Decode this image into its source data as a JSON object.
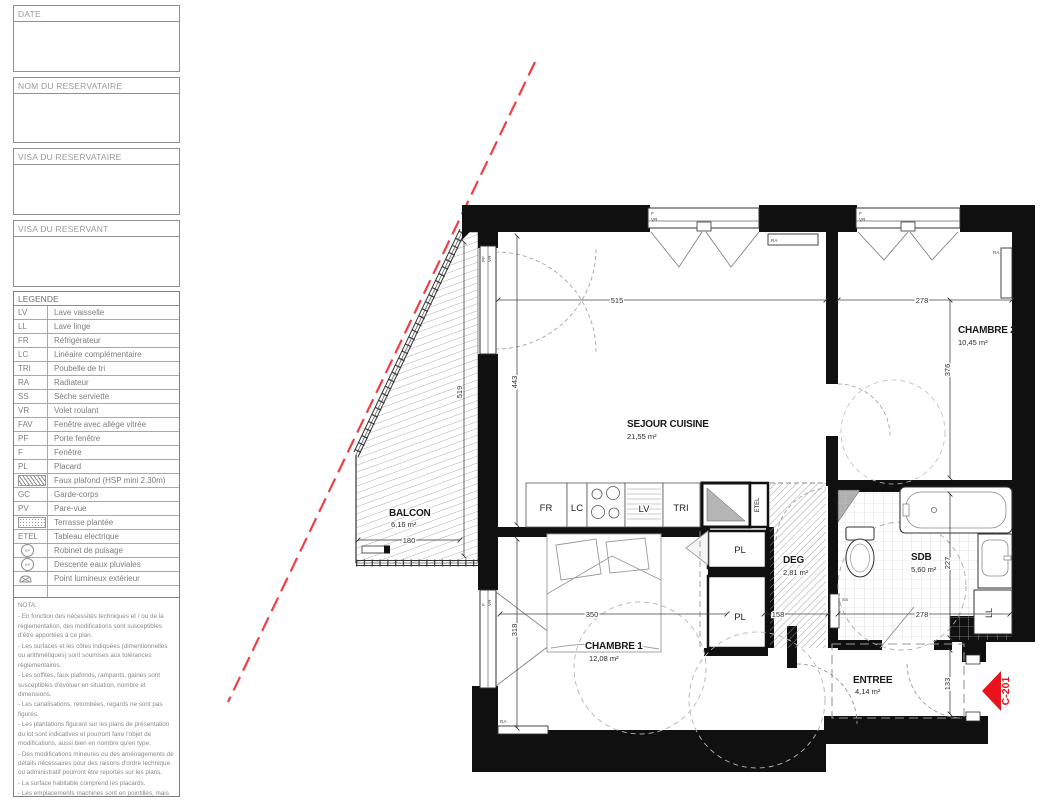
{
  "title_block": {
    "boxes": [
      {
        "label": "DATE"
      },
      {
        "label": "NOM DU RESERVATAIRE"
      },
      {
        "label": "VISA DU RESERVATAIRE"
      },
      {
        "label": "VISA DU RESERVANT"
      }
    ]
  },
  "legend": {
    "title": "LEGENDE",
    "items": [
      {
        "abbr": "LV",
        "label": "Lave vaisselle"
      },
      {
        "abbr": "LL",
        "label": "Lave linge"
      },
      {
        "abbr": "FR",
        "label": "Réfrigérateur"
      },
      {
        "abbr": "LC",
        "label": "Linéaire complémentaire"
      },
      {
        "abbr": "TRI",
        "label": "Poubelle de tri"
      },
      {
        "abbr": "RA",
        "label": "Radiateur"
      },
      {
        "abbr": "SS",
        "label": "Sèche serviette"
      },
      {
        "abbr": "VR",
        "label": "Volet roulant"
      },
      {
        "abbr": "FAV",
        "label": "Fenêtre avec allège vitrée"
      },
      {
        "abbr": "PF",
        "label": "Porte fenêtre"
      },
      {
        "abbr": "F",
        "label": "Fenêtre"
      },
      {
        "abbr": "PL",
        "label": "Placard"
      },
      {
        "abbr": "",
        "label": "Faux plafond (HSP mini 2.30m)",
        "icon": "hatch"
      },
      {
        "abbr": "GC",
        "label": "Garde-corps"
      },
      {
        "abbr": "PV",
        "label": "Pare-vue"
      },
      {
        "abbr": "",
        "label": "Terrasse plantée",
        "icon": "dots"
      },
      {
        "abbr": "ETEL",
        "label": "Tableau electrique"
      },
      {
        "abbr": "RP",
        "label": "Robinet de puisage",
        "icon": "rp"
      },
      {
        "abbr": "EP",
        "label": "Descente eaux pluviales",
        "icon": "ep"
      },
      {
        "abbr": "",
        "label": "Point lumineux extérieur",
        "icon": "lamp"
      }
    ]
  },
  "nota": {
    "title": "NOTA:",
    "lines": [
      "- En fonction des nécessités techniques et / ou de la réglementation, des modifications sont susceptibles d'être apportées à ce plan.",
      "- Les surfaces et les côtes indiquées (dimentionnelles ou arithmétiques) sont soumises aux tolérances réglementaires.",
      "- Les soffites, faux plafonds, rampants, gaines sont susceptibles d'évoluer en situation, nombre et dimensions.",
      "- Les canalisations, retombées, regards ne sont pas figurés.",
      "- Les plantations figurant sur les plans de présentation du lot sont indicatives et pourront faire l'objet de modifications, aussi bien en nombre qu'en type.",
      "- Des modifications mineures ou des aménagements de détails nécessaires pour des raisons d'ordre technique ou administratif pourront être reportés sur les plans.",
      "- La surface habitable comprend les placards.",
      "- Les emplacements machines sont en pointillés, mais les appareils ne sont pas fournis.",
      "- La literie indiquée dans la chambre est à titre indicatif de la norme handicapée. La literie est non fournie."
    ]
  },
  "plan": {
    "rooms": {
      "sejour": {
        "name": "SEJOUR CUISINE",
        "area": "21,55 m²"
      },
      "chambre2": {
        "name": "CHAMBRE 2",
        "area": "10,45 m²"
      },
      "chambre1": {
        "name": "CHAMBRE 1",
        "area": "12,08 m²"
      },
      "balcon": {
        "name": "BALCON",
        "area": "6,16 m²"
      },
      "deg": {
        "name": "DEG",
        "area": "2,81 m²"
      },
      "sdb": {
        "name": "SDB",
        "area": "5,60 m²"
      },
      "entree": {
        "name": "ENTREE",
        "area": "4,14 m²"
      }
    },
    "fixtures": {
      "fr": "FR",
      "lc": "LC",
      "lv": "LV",
      "tri": "TRI",
      "pl": "PL",
      "ll": "LL",
      "etel": "ETEL",
      "ss": "SS",
      "ra": "RA"
    },
    "windows": {
      "f": "F",
      "vr": "VR",
      "pf": "PF"
    },
    "dims": {
      "sejour_width": "515",
      "chambre2_width": "278",
      "sejour_height": "443",
      "balcon_height": "519",
      "chambre2_height": "376",
      "sdb_height": "227",
      "entree_height": "133",
      "chambre1_width": "350",
      "chambre1_height": "318",
      "deg_width": "158",
      "sdb_width": "278",
      "balcon_width": "180"
    },
    "marker": {
      "label": "C-201",
      "color": "#e8131d"
    }
  }
}
